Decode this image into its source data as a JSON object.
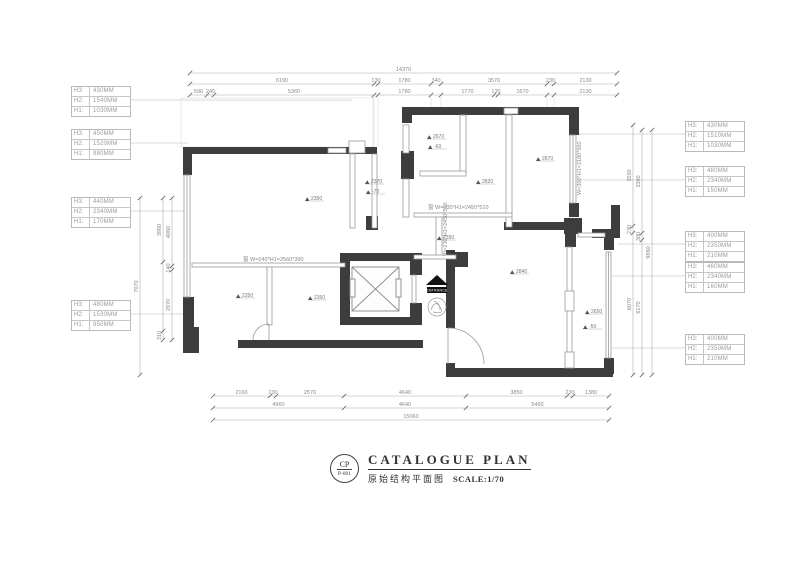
{
  "colors": {
    "wall": "#3d3d3d",
    "thin_line": "#9a9a9a",
    "dim_line": "#aaaaaa",
    "dim_text": "#8a8a8a",
    "leader": "#cccccc",
    "title": "#333333"
  },
  "title_block": {
    "stamp_code": "CP",
    "stamp_number": "P-001",
    "title_en": "CATALOGUE  PLAN",
    "title_cn": "原始结构平面图",
    "scale_label": "SCALE:1/70"
  },
  "height_tables": {
    "left": [
      {
        "rows": [
          {
            "label": "H3:",
            "value": "430MM"
          },
          {
            "label": "H2:",
            "value": "1540MM"
          },
          {
            "label": "H1:",
            "value": "1030MM"
          }
        ]
      },
      {
        "rows": [
          {
            "label": "H3:",
            "value": "450MM"
          },
          {
            "label": "H2:",
            "value": "1520MM"
          },
          {
            "label": "H1:",
            "value": "980MM"
          }
        ]
      },
      {
        "rows": [
          {
            "label": "H3:",
            "value": "440MM"
          },
          {
            "label": "H2:",
            "value": "2340MM"
          },
          {
            "label": "H1:",
            "value": "170MM"
          }
        ]
      },
      {
        "rows": [
          {
            "label": "H3:",
            "value": "480MM"
          },
          {
            "label": "H2:",
            "value": "1530MM"
          },
          {
            "label": "H1:",
            "value": "950MM"
          }
        ]
      }
    ],
    "right": [
      {
        "rows": [
          {
            "label": "H3:",
            "value": "430MM"
          },
          {
            "label": "H2:",
            "value": "1510MM"
          },
          {
            "label": "H1:",
            "value": "1030MM"
          }
        ]
      },
      {
        "rows": [
          {
            "label": "H3:",
            "value": "480MM"
          },
          {
            "label": "H2:",
            "value": "2340MM"
          },
          {
            "label": "H1:",
            "value": "150MM"
          }
        ]
      },
      {
        "rows": [
          {
            "label": "H3:",
            "value": "400MM"
          },
          {
            "label": "H2:",
            "value": "2350MM"
          },
          {
            "label": "H1:",
            "value": "210MM"
          }
        ]
      },
      {
        "rows": [
          {
            "label": "H3:",
            "value": "460MM"
          },
          {
            "label": "H2:",
            "value": "2340MM"
          },
          {
            "label": "H1:",
            "value": "160MM"
          }
        ]
      },
      {
        "rows": [
          {
            "label": "H3:",
            "value": "400MM"
          },
          {
            "label": "H2:",
            "value": "2350MM"
          },
          {
            "label": "H1:",
            "value": "210MM"
          }
        ]
      }
    ]
  },
  "dimensions": {
    "top_total": [
      "14370"
    ],
    "top_row2": [
      "6190",
      "130",
      "1780",
      "340",
      "3570",
      "230",
      "2130"
    ],
    "top_row3": [
      "590",
      "240",
      "5360",
      "1780",
      "1770",
      "130",
      "1670",
      "2130"
    ],
    "bottom_row1": [
      "2160",
      "230",
      "2570",
      "4640",
      "3850",
      "230",
      "1380"
    ],
    "bottom_row2": [
      "4960",
      "4640",
      "5460"
    ],
    "bottom_total": [
      "15060"
    ],
    "left_total": [
      "7070"
    ],
    "left_inner": [
      "3960",
      "310"
    ],
    "left_outer": [
      "4060",
      "140",
      "2870"
    ],
    "right_inner": [
      "3550",
      "230",
      "6070"
    ],
    "right_outer": [
      "3380",
      "300",
      "6170"
    ],
    "right_total": [
      "9860"
    ]
  },
  "spot_heights": [
    "2350",
    "2370",
    "-70",
    "2670",
    "-60",
    "2670",
    "2820",
    "2350",
    "2350",
    "2350",
    "2840",
    "2650",
    "-50"
  ],
  "window_specs": [
    "窗 W=230*H1=2450*510",
    "窗 W=240*H1=2560*390",
    "W=300*H1=2180*560",
    "W=230*H1=2450*510"
  ],
  "entrance": {
    "label": "ENTRANCE"
  }
}
